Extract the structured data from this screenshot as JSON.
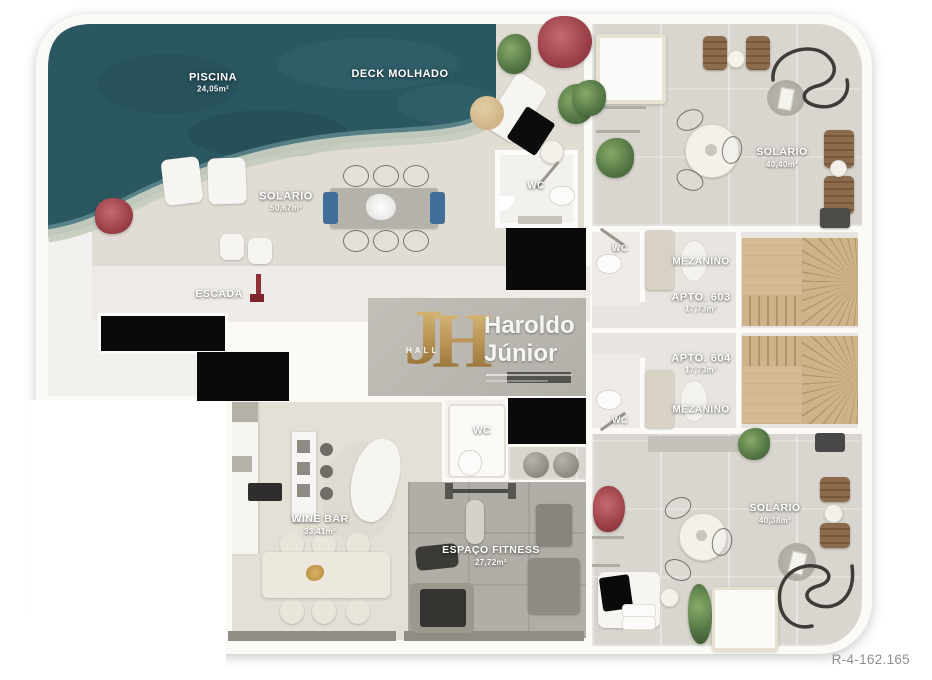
{
  "title": "Penthouse floor plan render",
  "ref_code": "R-4-162.165",
  "watermark": {
    "monogram_j": "J",
    "monogram_h": "H",
    "hall": "HALL",
    "name_line1": "Haroldo",
    "name_line2": "Júnior"
  },
  "labels": {
    "piscina": {
      "name": "PISCINA",
      "area": "24,05m²"
    },
    "deck_molhado": {
      "name": "DECK MOLHADO"
    },
    "solario_deck": {
      "name": "SOLÁRIO",
      "area": "50,67m²"
    },
    "wc_deck": {
      "name": "WC"
    },
    "escada": {
      "name": "ESCADA"
    },
    "wine_bar": {
      "name": "WINE BAR",
      "area": "33,41m²"
    },
    "wc_fitness": {
      "name": "WC"
    },
    "espaco_fitness": {
      "name": "ESPAÇO FITNESS",
      "area": "27,72m²"
    },
    "solario_top": {
      "name": "SOLÁRIO",
      "area": "40,40m²"
    },
    "solario_bottom": {
      "name": "SOLÁRIO",
      "area": "40,38m²"
    },
    "apto_603": {
      "name": "APTO. 603",
      "area": "17,73m²"
    },
    "apto_604": {
      "name": "APTO. 604",
      "area": "17,73m²"
    },
    "mezanino_603": {
      "name": "MEZANINO"
    },
    "mezanino_604": {
      "name": "MEZANINO"
    },
    "wc_603": {
      "name": "WC"
    },
    "wc_604": {
      "name": "WC"
    }
  },
  "colors": {
    "pool_water": "#2b5761",
    "deck_floor": "#e1ddd5",
    "terrace_floor": "#d9d6cf",
    "hall_floor": "#b8b5af",
    "fitness_floor": "#b1aea7",
    "stairs_wood": "#cdb28a",
    "shaft_black": "#0a0a0a",
    "wall_white": "#fbfaf7",
    "label_text": "#ffffff",
    "watermark_gold": "#c9a45c",
    "ref_text": "#8f8f8f"
  }
}
